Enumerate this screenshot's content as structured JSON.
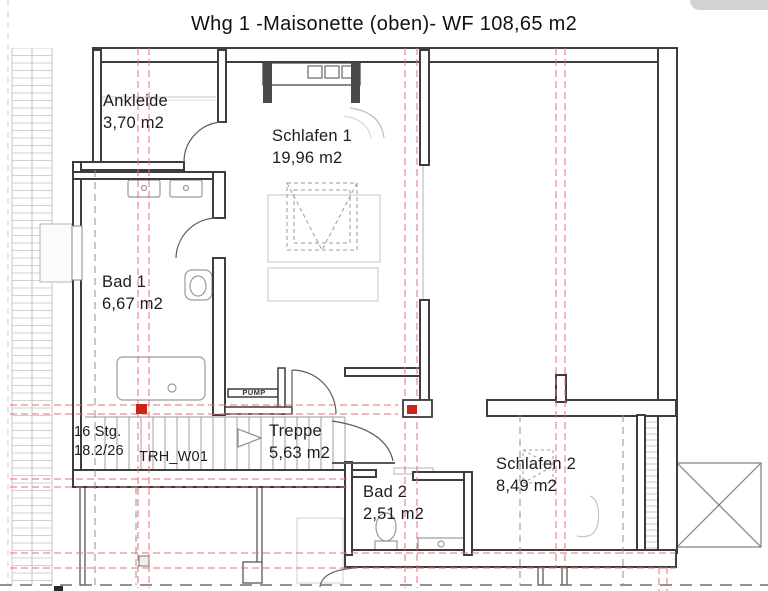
{
  "title": "Whg 1 -Maisonette (oben)- WF 108,65 m2",
  "rooms": {
    "ankleide": {
      "name": "Ankleide",
      "area": "3,70 m2"
    },
    "schlafen1": {
      "name": "Schlafen 1",
      "area": "19,96 m2"
    },
    "bad1": {
      "name": "Bad 1",
      "area": "6,67 m2"
    },
    "treppe": {
      "name": "Treppe",
      "area": "5,63 m2"
    },
    "bad2": {
      "name": "Bad 2",
      "area": "2,51 m2"
    },
    "schlafen2": {
      "name": "Schlafen 2",
      "area": "8,49 m2"
    }
  },
  "stair_note": {
    "steps": "16 Stg.",
    "riser_tread": "18.2/26",
    "stair_id": "TRH_W01"
  },
  "equipment": {
    "pump": "PUMP"
  },
  "colors": {
    "wall": "#3d3d3d",
    "axis_red": "#e57070",
    "marker_red": "#cc2418",
    "fixture_gray": "#9a9a9a",
    "furniture_gray": "#c4c4c4",
    "hatch_gray": "#cccccc",
    "dash_gray": "#8f8f8f"
  }
}
